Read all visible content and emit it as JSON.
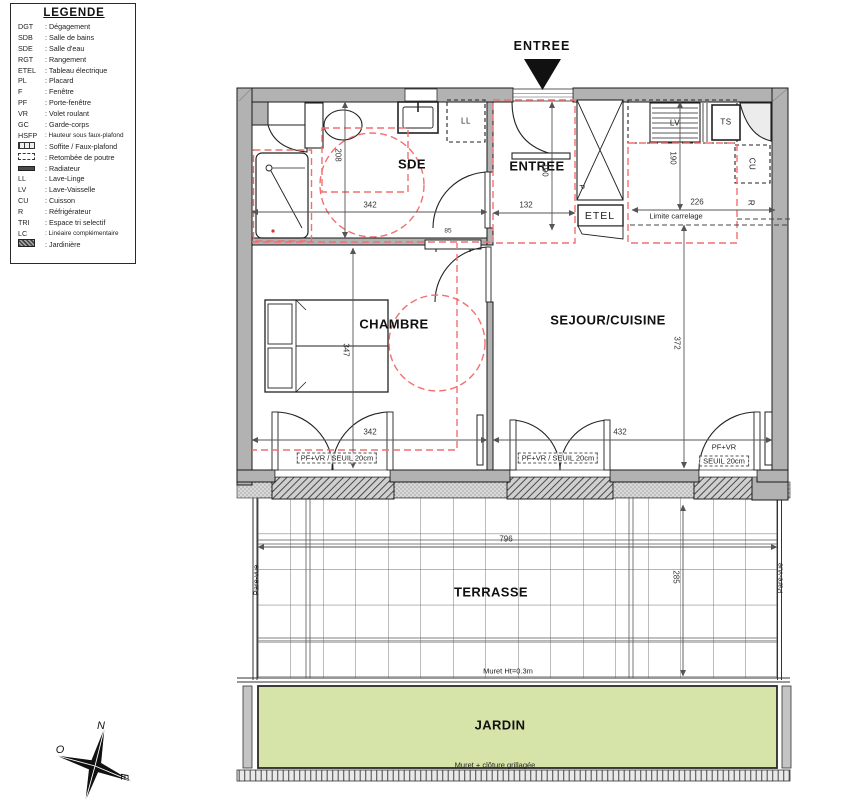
{
  "legend": {
    "title": "LEGENDE",
    "items": [
      {
        "abbr": "DGT",
        "label": ": Dégagement"
      },
      {
        "abbr": "SDB",
        "label": ": Salle de bains"
      },
      {
        "abbr": "SDE",
        "label": ": Salle d'eau"
      },
      {
        "abbr": "RGT",
        "label": ": Rangement"
      },
      {
        "abbr": "ETEL",
        "label": ": Tableau électrique"
      },
      {
        "abbr": "PL",
        "label": ": Placard"
      },
      {
        "abbr": "F",
        "label": ": Fenêtre"
      },
      {
        "abbr": "PF",
        "label": ": Porte-fenêtre"
      },
      {
        "abbr": "VR",
        "label": ": Volet roulant"
      },
      {
        "abbr": "GC",
        "label": ": Garde-corps"
      },
      {
        "abbr": "HSFP",
        "label": ": Hauteur sous faux-plafond"
      },
      {
        "abbr": "",
        "icon": "soffit-icon",
        "label": ": Soffite / Faux-plafond"
      },
      {
        "abbr": "",
        "icon": "beam-icon",
        "label": ": Retombée de poutre"
      },
      {
        "abbr": "",
        "icon": "radiator-icon",
        "label": ": Radiateur"
      },
      {
        "abbr": "LL",
        "label": ": Lave-Linge"
      },
      {
        "abbr": "LV",
        "label": ": Lave-Vaisselle"
      },
      {
        "abbr": "CU",
        "label": ": Cuisson"
      },
      {
        "abbr": "R",
        "label": ": Réfrigérateur"
      },
      {
        "abbr": "TRI",
        "label": ": Espace tri selectif"
      },
      {
        "abbr": "LC",
        "label": ": Linéaire complémentaire"
      },
      {
        "abbr": "",
        "icon": "jardiniere-icon",
        "label": ": Jardinière"
      }
    ]
  },
  "entry_marker": "ENTREE",
  "rooms": {
    "sde": "SDE",
    "entree": "ENTREE",
    "chambre": "CHAMBRE",
    "sejour": "SEJOUR/CUISINE",
    "terrasse": "TERRASSE",
    "jardin": "JARDIN"
  },
  "labels": {
    "ll": "LL",
    "lv": "LV",
    "ts": "TS",
    "cu": "CU",
    "r": "R",
    "p": "P",
    "etel": "ETEL",
    "limite_carrelage": "Limite carrelage",
    "pf_vr_seuil": "PF+VR / SEUIL 20cm",
    "pf_vr": "PF+VR",
    "seuil": "SEUIL 20cm",
    "pare_vue": "Pare-vue",
    "muret": "Muret Ht=0.3m",
    "cloture": "Muret + clôture grillagée"
  },
  "dims": {
    "sde_w": "342",
    "sde_h": "208",
    "entree_w": "132",
    "entree_h": "190",
    "kitchen_w": "226",
    "kitchen_h": "190",
    "chambre_h": "347",
    "chambre_w": "342",
    "sejour_h": "372",
    "sejour_w": "432",
    "radiator_w": "85",
    "terrasse_w": "796",
    "terrasse_h": "285"
  },
  "compass": {
    "n": "N",
    "o": "O",
    "e": "E"
  },
  "colors": {
    "wall": "#b2b2b2",
    "accent_red": "#f26f6f",
    "garden_green": "#d6e4a9",
    "line": "#222222",
    "dim_line": "#555555"
  }
}
